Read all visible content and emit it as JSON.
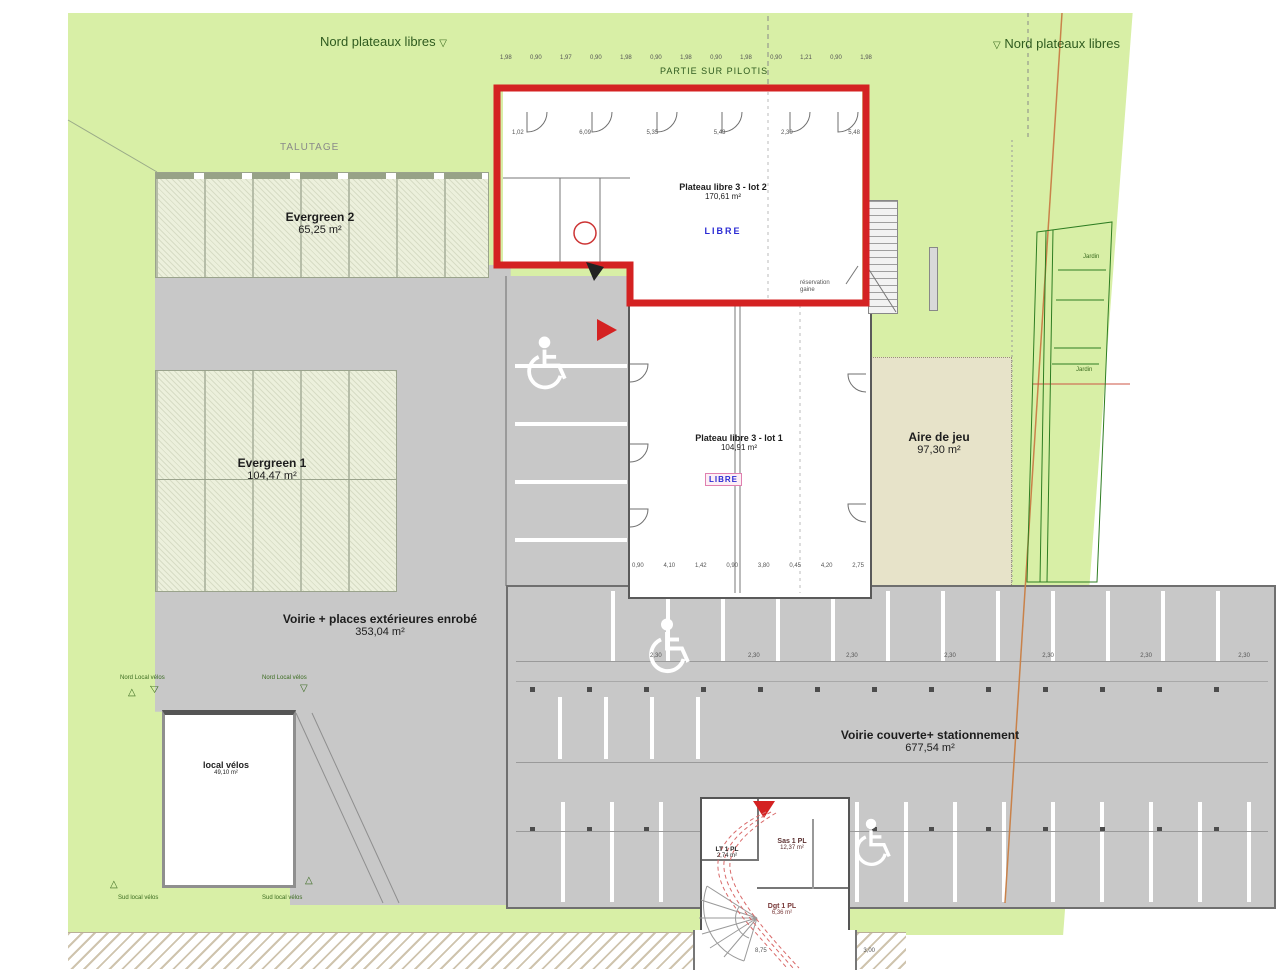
{
  "site": {
    "nord_plateaux_left": "Nord plateaux libres",
    "nord_plateaux_right": "Nord plateaux libres",
    "talutage": "TALUTAGE",
    "partie_sur_pilotis": "PARTIE SUR PILOTIS",
    "jardin_1": "Jardin",
    "jardin_2": "Jardin"
  },
  "areas": {
    "evergreen2": {
      "name": "Evergreen 2",
      "area": "65,25 m²"
    },
    "evergreen1": {
      "name": "Evergreen 1",
      "area": "104,47 m²"
    },
    "lot2": {
      "name": "Plateau libre 3 - lot 2",
      "area": "170,61 m²",
      "status": "LIBRE"
    },
    "lot1": {
      "name": "Plateau libre 3 - lot 1",
      "area": "104,91 m²",
      "status": "LIBRE"
    },
    "aire_de_jeu": {
      "name": "Aire de jeu",
      "area": "97,30 m²"
    },
    "voirie_ext": {
      "name": "Voirie + places extérieures enrobé",
      "area": "353,04 m²"
    },
    "voirie_couverte": {
      "name": "Voirie couverte+ stationnement",
      "area": "677,54 m²"
    },
    "local_velos": {
      "name": "local vélos",
      "area": "49,10 m²"
    },
    "sas": {
      "name": "Sas 1 PL",
      "area": "12,37 m²"
    },
    "lt": {
      "name": "LT 1 PL",
      "area": "2,74 m²"
    },
    "dgt": {
      "name": "Dgt 1 PL",
      "area": "6,36 m²"
    }
  },
  "annotations": {
    "reservation_gaine": "réservation gaine",
    "nord_local_velos_1": "Nord Local vélos",
    "nord_local_velos_2": "Nord Local vélos",
    "sud_local_velos_1": "Sud local vélos",
    "sud_local_velos_2": "Sud local vélos"
  },
  "dims": {
    "top": [
      "1,98",
      "0,90",
      "1,97",
      "0,90",
      "1,98",
      "0,90",
      "1,98",
      "0,90",
      "1,98",
      "0,90",
      "1,21",
      "0,90",
      "1,98"
    ],
    "lot2_row": [
      "1,02",
      "6,09",
      "5,35",
      "5,43",
      "2,30",
      "5,48"
    ],
    "lot1_row": [
      "0,90",
      "4,10",
      "1,42",
      "0,90",
      "3,80",
      "0,45",
      "4,20",
      "2,75"
    ],
    "parking_row": [
      "2,30",
      "2,30",
      "2,30",
      "2,30",
      "2,30",
      "2,30",
      "2,30"
    ],
    "bottom_row": [
      "8,75",
      "3,00"
    ]
  },
  "glyphs": {
    "tri_down": "▽",
    "tri_up": "△"
  },
  "colors": {
    "highlight_red": "#d42222",
    "libre_blue": "#2b2bd4",
    "site_green": "#d8efa6",
    "parking_gray": "#c8c8c8",
    "aire_beige": "#e7e3c9"
  }
}
